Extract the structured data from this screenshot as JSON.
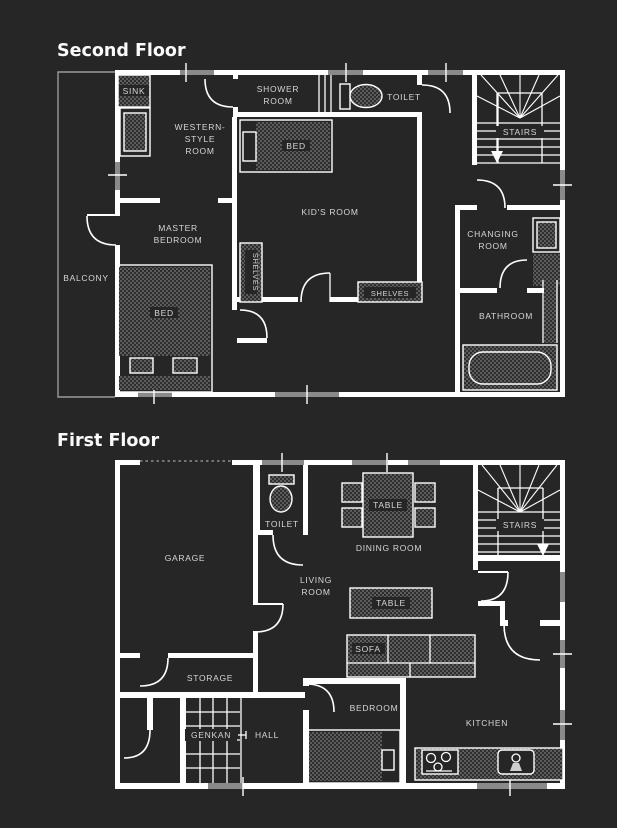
{
  "colors": {
    "background": "#262626",
    "wall": "#ffffff",
    "label": "#d6d6d6",
    "window": "#8a8a8a",
    "balcony_line": "#9a9a9a",
    "furniture_dot": "#5c5c5c"
  },
  "floor2": {
    "title": "Second Floor",
    "labels": {
      "sink": "SINK",
      "western_line1": "WESTERN-",
      "western_line2": "STYLE",
      "western_line3": "ROOM",
      "shower_line1": "SHOWER",
      "shower_line2": "ROOM",
      "toilet": "TOILET",
      "stairs": "STAIRS",
      "master_line1": "MASTER",
      "master_line2": "BEDROOM",
      "master_bed": "BED",
      "kids_bed": "BED",
      "kids_room": "KID'S ROOM",
      "shelves_left": "SHELVES",
      "shelves_bottom": "SHELVES",
      "balcony": "BALCONY",
      "changing_line1": "CHANGING",
      "changing_line2": "ROOM",
      "bathroom": "BATHROOM"
    }
  },
  "floor1": {
    "title": "First Floor",
    "labels": {
      "garage": "GARAGE",
      "toilet": "TOILET",
      "dining_table": "TABLE",
      "dining_room": "DINING ROOM",
      "stairs": "STAIRS",
      "living_line1": "LIVING",
      "living_line2": "ROOM",
      "living_table": "TABLE",
      "sofa": "SOFA",
      "storage": "STORAGE",
      "genkan": "GENKAN",
      "hall": "HALL",
      "bedroom": "BEDROOM",
      "kitchen": "KITCHEN"
    }
  }
}
